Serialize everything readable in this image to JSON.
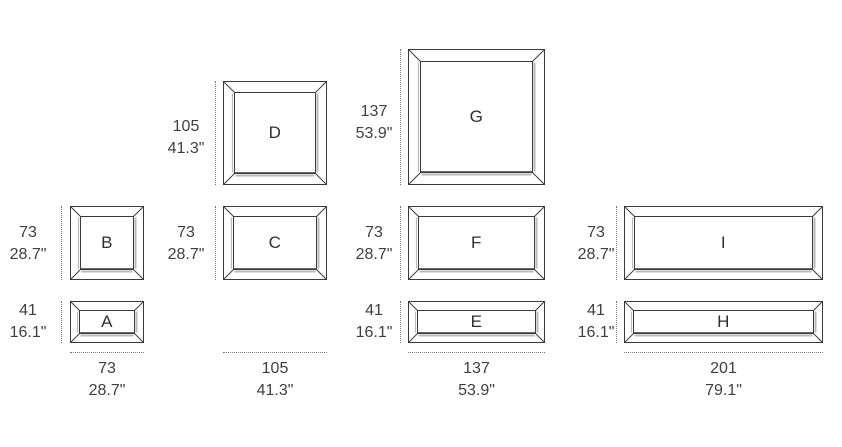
{
  "colors": {
    "line": "#3a3a3a",
    "shade": "#b9b9b9",
    "text": "#3f3f3f",
    "dotted": "#767676",
    "background": "#ffffff"
  },
  "diagram": {
    "columns": [
      {
        "bottom_width": {
          "cm": "73",
          "inch": "28.7\""
        },
        "frames": [
          {
            "letter": "B",
            "height": {
              "cm": "73",
              "inch": "28.7\""
            }
          },
          {
            "letter": "A",
            "height": {
              "cm": "41",
              "inch": "16.1\""
            }
          }
        ]
      },
      {
        "bottom_width": {
          "cm": "105",
          "inch": "41.3\""
        },
        "frames": [
          {
            "letter": "D",
            "height": {
              "cm": "105",
              "inch": "41.3\""
            }
          },
          {
            "letter": "C",
            "height": {
              "cm": "73",
              "inch": "28.7\""
            }
          }
        ]
      },
      {
        "bottom_width": {
          "cm": "137",
          "inch": "53.9\""
        },
        "frames": [
          {
            "letter": "G",
            "height": {
              "cm": "137",
              "inch": "53.9\""
            }
          },
          {
            "letter": "F",
            "height": {
              "cm": "73",
              "inch": "28.7\""
            }
          },
          {
            "letter": "E",
            "height": {
              "cm": "41",
              "inch": "16.1\""
            }
          }
        ]
      },
      {
        "bottom_width": {
          "cm": "201",
          "inch": "79.1\""
        },
        "frames": [
          {
            "letter": "I",
            "height": {
              "cm": "73",
              "inch": "28.7\""
            }
          },
          {
            "letter": "H",
            "height": {
              "cm": "41",
              "inch": "16.1\""
            }
          }
        ]
      }
    ]
  }
}
